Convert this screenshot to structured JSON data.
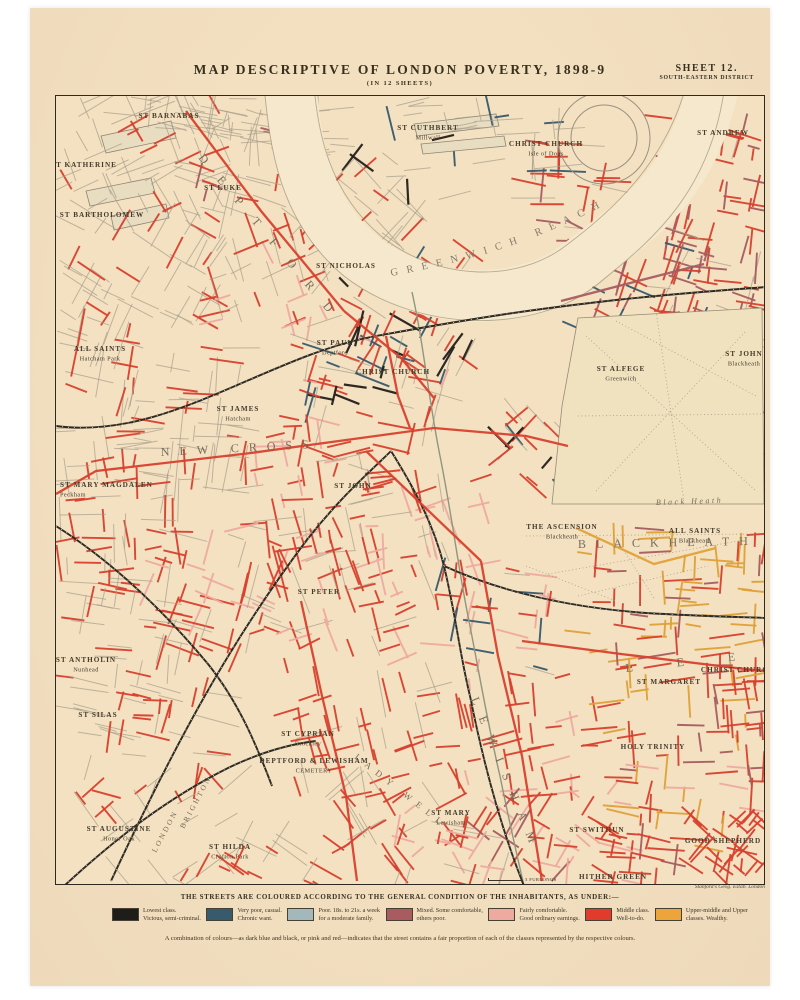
{
  "sheet": {
    "title": "MAP DESCRIPTIVE OF LONDON POVERTY, 1898-9",
    "subtitle": "(IN 12 SHEETS)",
    "sheet_label": "SHEET 12.",
    "district": "SOUTH-EASTERN DISTRICT",
    "scale_label": "3 FURLONGS",
    "credit": "Stanford's Geog. Estab. London",
    "paper_color": "#f2dfbf"
  },
  "legend": {
    "heading": "THE STREETS ARE COLOURED ACCORDING TO THE GENERAL CONDITION OF THE INHABITANTS, AS UNDER:—",
    "items": [
      {
        "line1": "Lowest class.",
        "line2": "Vicious, semi-criminal.",
        "color": "#1f1d1a"
      },
      {
        "line1": "Very poor, casual.",
        "line2": "Chronic want.",
        "color": "#375a6d"
      },
      {
        "line1": "Poor. 18s. to 21s. a week",
        "line2": "for a moderate family.",
        "color": "#a3b8bb"
      },
      {
        "line1": "Mixed. Some comfortable,",
        "line2": "others poor.",
        "color": "#a85c60"
      },
      {
        "line1": "Fairly comfortable.",
        "line2": "Good ordinary earnings.",
        "color": "#efaaa0"
      },
      {
        "line1": "Middle class.",
        "line2": "Well-to-do.",
        "color": "#e23b2b"
      },
      {
        "line1": "Upper-middle and Upper",
        "line2": "classes. Wealthy.",
        "color": "#eda43b"
      }
    ],
    "note": "A combination of colours—as dark blue and black, or pink and red—indicates that the street contains a fair proportion of each of the classes represented by the respective colours."
  },
  "map_labels": {
    "river_label": "GREENWICH REACH",
    "parishes": [
      {
        "name": "ST BARNABAS",
        "x": 113,
        "y": 22
      },
      {
        "name": "ST KATHERINE",
        "x": 28,
        "y": 71
      },
      {
        "name": "ST BARTHOLOMEW",
        "x": 46,
        "y": 121
      },
      {
        "name": "ST CUTHBERT",
        "sub": "Millwall",
        "x": 372,
        "y": 34
      },
      {
        "name": "CHRIST CHURCH",
        "sub": "Isle of Dogs",
        "x": 490,
        "y": 50
      },
      {
        "name": "ST ANDREW",
        "x": 667,
        "y": 39
      },
      {
        "name": "ST LUKE",
        "x": 167,
        "y": 94
      },
      {
        "name": "ST NICHOLAS",
        "x": 290,
        "y": 172
      },
      {
        "name": "ST PAUL",
        "sub": "Deptford",
        "x": 279,
        "y": 249
      },
      {
        "name": "CHRIST CHURCH",
        "x": 337,
        "y": 278
      },
      {
        "name": "ALL SAINTS",
        "sub": "Hatcham Park",
        "x": 44,
        "y": 255
      },
      {
        "name": "ST JAMES",
        "sub": "Hatcham",
        "x": 182,
        "y": 315
      },
      {
        "name": "ST JOHN",
        "x": 297,
        "y": 392
      },
      {
        "name": "ST ALFEGE",
        "sub": "Greenwich",
        "x": 565,
        "y": 275
      },
      {
        "name": "ST JOHN",
        "sub": "Blackheath",
        "x": 688,
        "y": 260
      },
      {
        "name": "THE ASCENSION",
        "sub": "Blackheath",
        "x": 506,
        "y": 433
      },
      {
        "name": "ALL SAINTS",
        "sub": "Blackheath",
        "x": 639,
        "y": 437
      },
      {
        "name": "ST MARY MAGDALEN",
        "sub": "Peckham",
        "x": 4,
        "y": 391,
        "anchor": "s"
      },
      {
        "name": "ST PETER",
        "x": 263,
        "y": 498
      },
      {
        "name": "ST ANTHOLIN",
        "sub": "Nunhead",
        "x": 30,
        "y": 566
      },
      {
        "name": "ST SILAS",
        "x": 42,
        "y": 621
      },
      {
        "name": "ST CYPRIAN",
        "sub": "Brockley",
        "x": 252,
        "y": 640
      },
      {
        "name": "DEPTFORD & LEWISHAM",
        "sub": "CEMETERY",
        "x": 258,
        "y": 667,
        "size": 5
      },
      {
        "name": "ST AUGUSTINE",
        "sub": "Honor Oak",
        "x": 63,
        "y": 735
      },
      {
        "name": "ST HILDA",
        "sub": "Crofton Park",
        "x": 174,
        "y": 753
      },
      {
        "name": "ST MARY",
        "sub": "Lewisham",
        "x": 395,
        "y": 719
      },
      {
        "name": "ST SWITHUN",
        "x": 541,
        "y": 736
      },
      {
        "name": "HOLY TRINITY",
        "x": 597,
        "y": 653
      },
      {
        "name": "ST MARGARET",
        "x": 613,
        "y": 588
      },
      {
        "name": "CHRIST CHURCH",
        "x": 682,
        "y": 576
      },
      {
        "name": "GOOD SHEPHERD",
        "x": 667,
        "y": 747
      },
      {
        "name": "HITHER GREEN",
        "x": 557,
        "y": 783
      }
    ],
    "districts": [
      {
        "text": "DEPTFORD",
        "x": 142,
        "y": 62,
        "rotate": 50,
        "spacing": 20,
        "size": 12
      },
      {
        "text": "NEW CROSS",
        "x": 105,
        "y": 360,
        "rotate": -3,
        "spacing": 10,
        "size": 12
      },
      {
        "text": "BLACKHEATH",
        "x": 522,
        "y": 452,
        "rotate": -1,
        "spacing": 10,
        "size": 12
      },
      {
        "text": "LEE",
        "x": 570,
        "y": 576,
        "rotate": -6,
        "spacing": 44,
        "size": 12
      },
      {
        "text": "LEWISHAM",
        "x": 415,
        "y": 603,
        "rotate": 68,
        "spacing": 13,
        "size": 12
      },
      {
        "text": "LADY WELL",
        "x": 298,
        "y": 662,
        "rotate": 38,
        "spacing": 7,
        "size": 9
      },
      {
        "text": "LONDON",
        "x": 100,
        "y": 757,
        "rotate": -62,
        "spacing": 2.5,
        "size": 7.5
      },
      {
        "text": "BRIGHTON",
        "x": 128,
        "y": 733,
        "rotate": -62,
        "spacing": 2.5,
        "size": 7.5
      },
      {
        "text": "Black Heath",
        "x": 600,
        "y": 409,
        "rotate": -2,
        "spacing": 2.5,
        "size": 8,
        "italic": true
      }
    ]
  }
}
